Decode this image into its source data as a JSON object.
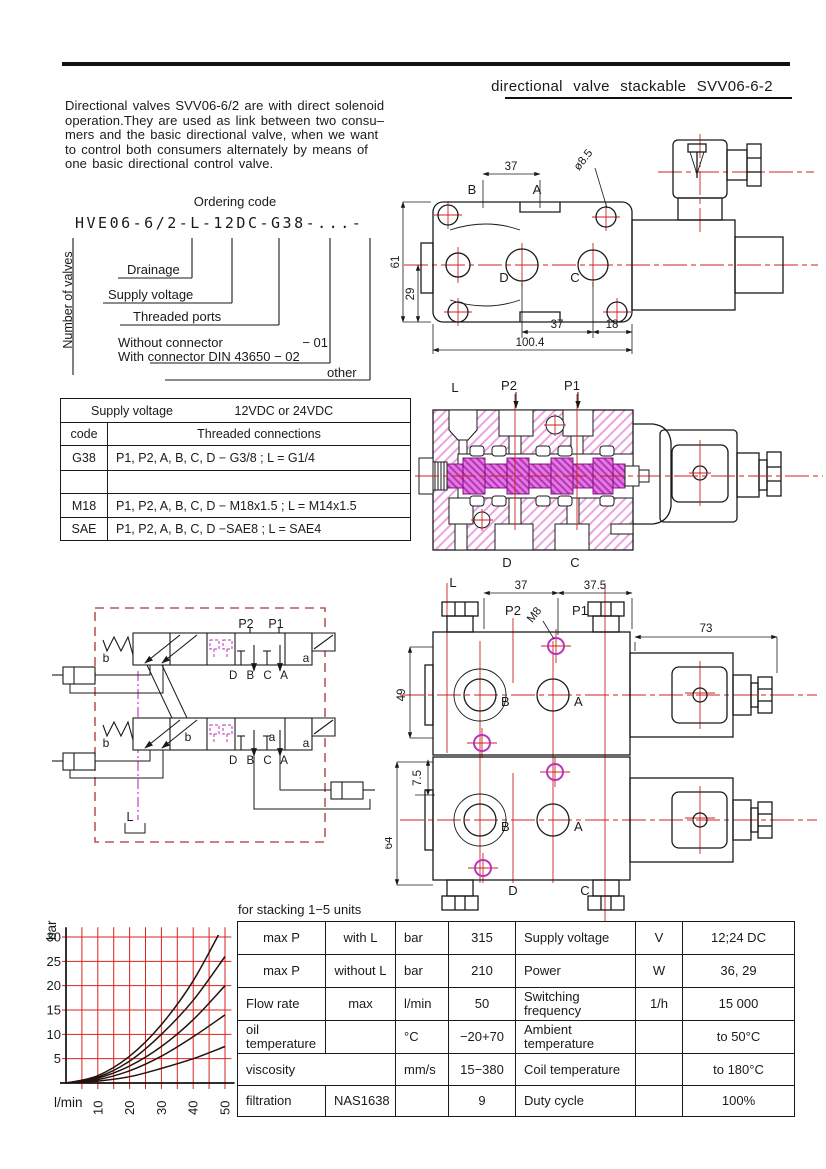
{
  "header": {
    "title": "directional valve stackable SVV06-6-2"
  },
  "intro": {
    "text": "Directional valves SVV06-6/2 are with direct solenoid\noperation.They are used as link between two consu–\nmers and the basic directional valve, when we want\nto control both consumers alternately by means of\none basic directional control valve."
  },
  "ordering": {
    "title": "Ordering code",
    "code": "HVE06-6/2-L-12DC-G38-...-",
    "number_of_valves": "Number of valves",
    "drainage": "Drainage",
    "supply_voltage": "Supply voltage",
    "threaded_ports": "Threaded ports",
    "without_connector": "Without connector",
    "without_code": "−  01",
    "with_connector": "With connector DIN 43650 − 02",
    "other": "other"
  },
  "voltage_table": {
    "supply_label": "Supply voltage",
    "supply_value": "12VDC or 24VDC",
    "code_header": "code",
    "conn_header": "Threaded connections",
    "rows": [
      {
        "code": "G38",
        "conn": "P1, P2, A, B, C, D − G3/8 ; L = G1/4"
      },
      {
        "code": "",
        "conn": ""
      },
      {
        "code": "M18",
        "conn": "P1, P2, A, B, C, D − M18x1.5 ; L = M14x1.5"
      },
      {
        "code": "SAE",
        "conn": "P1, P2, A, B, C, D −SAE8 ; L = SAE4"
      }
    ]
  },
  "drawing_top": {
    "dim_37_top": "37",
    "dia": "ø8.5",
    "label_b": "B",
    "label_a": "A",
    "dim_61": "61",
    "dim_29": "29",
    "label_d": "D",
    "label_c": "C",
    "dim_37_bottom": "37",
    "dim_18": "18",
    "dim_100": "100.4"
  },
  "drawing_section": {
    "label_l": "L",
    "label_p2": "P2",
    "label_p1": "P1",
    "label_d": "D",
    "label_c": "C"
  },
  "schematic": {
    "p2": "P2",
    "p1": "P1",
    "b_top": "b",
    "a_top": "a",
    "b_bottom": "b",
    "a_bottom": "a",
    "b_inner": "b",
    "a_inner": "a",
    "ports_top": "D B C A",
    "ports_bottom": "D B C A",
    "l": "L"
  },
  "drawing_stacked": {
    "label_l": "L",
    "dim_37": "37",
    "dim_37_5": "37.5",
    "label_p2": "P2",
    "label_m8": "M8",
    "label_p1": "P1",
    "dim_73": "73",
    "dim_49": "49",
    "dim_7_5": "7.5",
    "dim_64": "64",
    "b1": "B",
    "a1": "A",
    "b2": "B",
    "a2": "A",
    "label_d": "D",
    "label_c": "C"
  },
  "chart_data": {
    "type": "line",
    "title": "",
    "ylabel": "bar",
    "xlabel": "l/min",
    "yticks": [
      5,
      10,
      15,
      20,
      25,
      30
    ],
    "xticks": [
      10,
      20,
      30,
      40,
      50
    ],
    "xlim": [
      0,
      52
    ],
    "ylim": [
      0,
      32
    ],
    "grid": true,
    "grid_color": "#dd2222",
    "x": [
      0,
      10,
      20,
      30,
      40,
      50
    ],
    "series": [
      {
        "name": "curve-1",
        "values": [
          0,
          1.5,
          5.5,
          12,
          21,
          33
        ]
      },
      {
        "name": "curve-2",
        "values": [
          0,
          1.2,
          4.5,
          10,
          17,
          26
        ]
      },
      {
        "name": "curve-3",
        "values": [
          0,
          1.0,
          3.5,
          7.5,
          13,
          20
        ]
      },
      {
        "name": "curve-4",
        "values": [
          0,
          0.7,
          2.5,
          5.5,
          9.5,
          14
        ]
      },
      {
        "name": "curve-5",
        "values": [
          0,
          0.4,
          1.3,
          3.0,
          5.0,
          7.5
        ]
      }
    ]
  },
  "spec_table": {
    "caption": "for stacking 1−5 units",
    "rows": [
      [
        "max P",
        "with L",
        "bar",
        "315",
        "Supply voltage",
        "V",
        "12;24 DC"
      ],
      [
        "max P",
        "without L",
        "bar",
        "210",
        "Power",
        "W",
        "36, 29"
      ],
      [
        "Flow rate",
        "max",
        "l/min",
        "50",
        "Switching\nfrequency",
        "1/h",
        "15 000"
      ],
      [
        "oil\ntemperature",
        "",
        "°C",
        "−20+70",
        "Ambient\ntemperature",
        "",
        "to 50°C"
      ],
      [
        "viscosity",
        "",
        "mm/s",
        "15−380",
        "Coil temperature",
        "",
        "to 180°C"
      ],
      [
        "filtration",
        "NAS1638",
        "",
        "9",
        "Duty cycle",
        "",
        "100%"
      ]
    ]
  },
  "colors": {
    "red": "#cc2222",
    "magenta": "#bb33bb",
    "pink_hatch": "#eda2e2",
    "dash_border": "#a83434"
  }
}
